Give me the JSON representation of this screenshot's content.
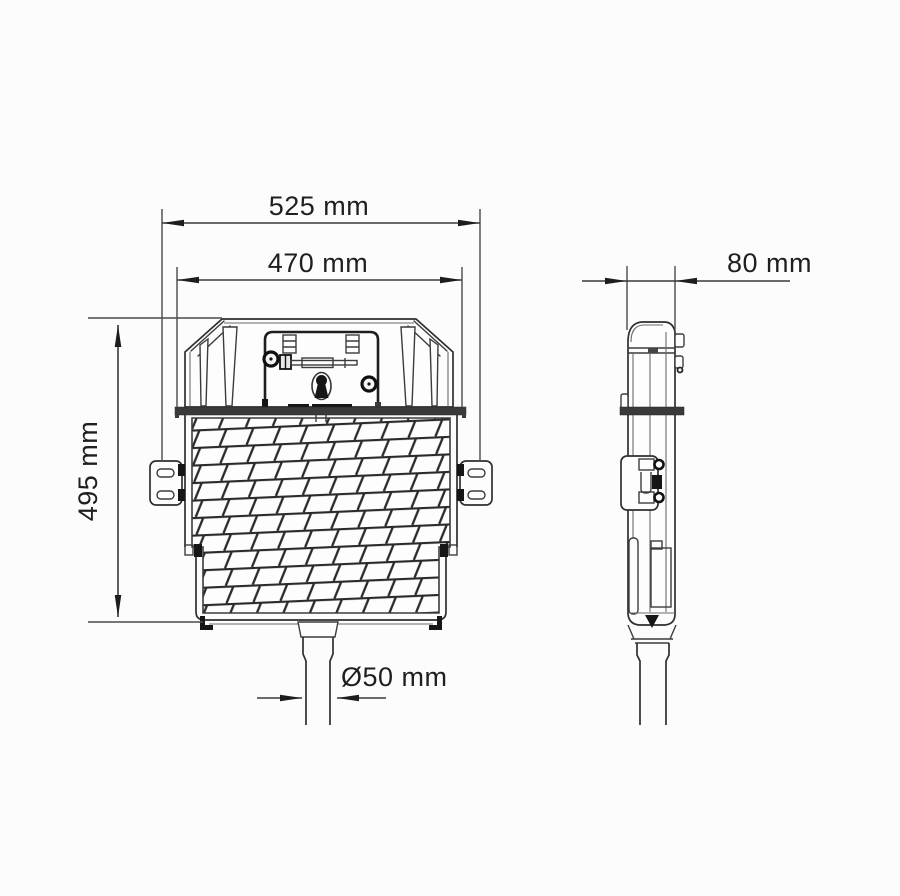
{
  "diagram": {
    "dimensions": {
      "outer_width": "525 mm",
      "tank_width": "470 mm",
      "height": "495 mm",
      "depth": "80 mm",
      "outlet_diameter": "Ø50 mm"
    },
    "colors": {
      "background": "#fcfcfc",
      "line": "#2f2f2f",
      "dark_fill": "#161616",
      "hatch": "#2a2a2a",
      "band": "#3a3a3a"
    }
  }
}
